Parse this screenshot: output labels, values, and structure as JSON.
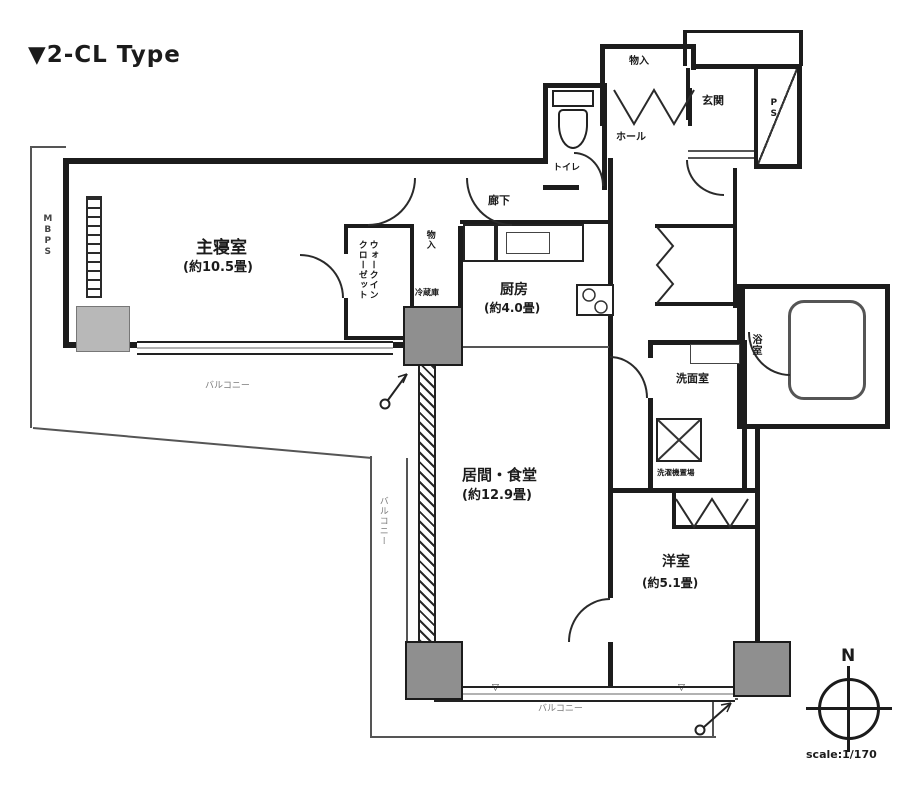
{
  "title": "▼2-CL Type",
  "plan": {
    "master_bedroom_name": "主寝室",
    "master_bedroom_size": "(約10.5畳)",
    "kitchen_name": "厨房",
    "kitchen_size": "(約4.0畳)",
    "living_dining_name": "居間・食堂",
    "living_dining_size": "(約12.9畳)",
    "western_room_name": "洋室",
    "western_room_size": "(約5.1畳)",
    "walk_in_closet": "ウォークイン\nクローゼット",
    "toilet": "トイレ",
    "hall": "ホール",
    "entrance": "玄関",
    "corridor": "廊下",
    "storage_hall": "物入",
    "storage_corridor": "物入",
    "fridge": "冷蔵庫",
    "powder_room": "洗面室",
    "bath": "浴室",
    "washer_note": "洗濯機置場",
    "balcony_left": "バルコニー",
    "balcony_side": "バルコニー",
    "balcony_bottom": "バルコニー",
    "meter_box": "MBPS",
    "pipe_space": "PS",
    "window_mark": "▽"
  },
  "compass": {
    "north_label": "N",
    "scale_label": "scale:1/170"
  }
}
